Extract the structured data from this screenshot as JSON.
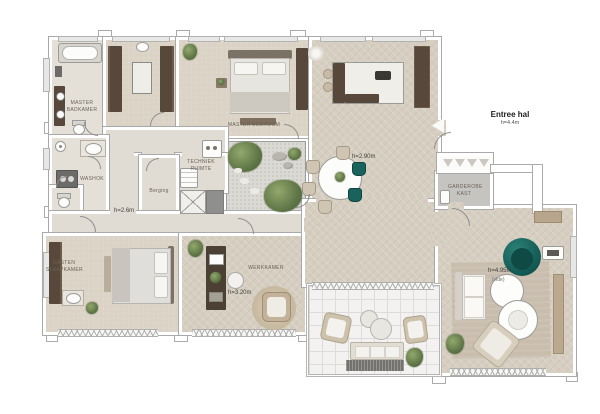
{
  "plan": {
    "entree": {
      "title": "Entree hal",
      "height": "h=4.4m"
    },
    "living": {
      "height": "h=4.95m",
      "note": "(vide)"
    },
    "dining": {
      "height": "h=2.90m"
    },
    "corridor": {
      "height": "h=2.6m"
    },
    "office": {
      "name": "WERKKAMER",
      "height": "h=3.20m"
    },
    "master_bedroom": {
      "name": "MASTER BEDROOM"
    },
    "master_bathroom": {
      "line1": "MASTER",
      "line2": "BADKAMER"
    },
    "guest_bedroom": {
      "line1": "GASTEN",
      "line2": "SLAAPKAMER"
    },
    "storage": {
      "name": "Berging"
    },
    "laundry": {
      "name": "WASHOK"
    },
    "wardrobe": {
      "line1": "GARDEROBE",
      "line2": "KAST"
    },
    "tech": {
      "line1": "TECHNIEK",
      "line2": "RUIMTE"
    }
  },
  "colors": {
    "floor_wood": "#d6cec0",
    "floor_light": "#e0dbd3",
    "wall_outline": "#a9a9a9",
    "furniture_dark": "#57483b",
    "accent_teal": "#145b55",
    "plant_green": "#5e7546",
    "rug": "#c9beae",
    "terrace_tile": "#f3f2f0"
  }
}
